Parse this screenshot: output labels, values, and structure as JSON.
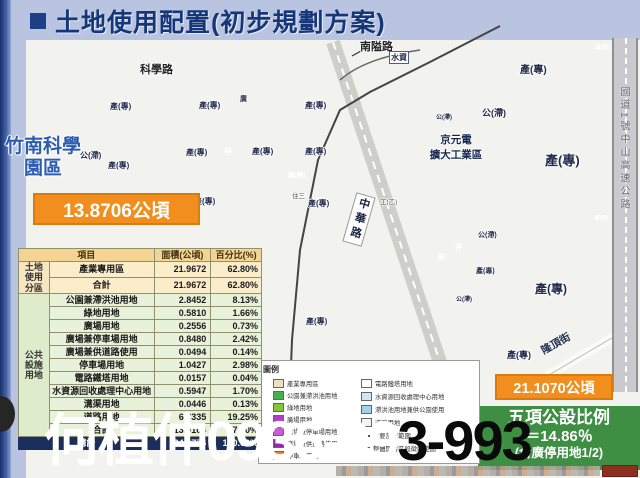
{
  "title": {
    "text": "土地使用配置(初步規劃方案)"
  },
  "watermark": {
    "white": "何植仲0936-99",
    "black": "3-993"
  },
  "colors": {
    "orange_box": "#f28e1d",
    "green_box": "#3e8f43",
    "total_row": "#1c2f5c",
    "title": "#16367a"
  },
  "map": {
    "roads": {
      "kexue": "科學路",
      "nanai": "南隘路",
      "zhonghua": "中華路",
      "longding": "隆頂街",
      "highway": "國道1號中山高速公路",
      "shuizi": "水資"
    },
    "labels": {
      "industrial": "產(專)",
      "park": "公(滯)",
      "parking": "停",
      "green": "綠",
      "plaza": "廣",
      "plaza_parking": "廣(停)",
      "plaza_road": "廣(道)",
      "jingyuan": "京元電\n擴大工業區",
      "zhusan": "住三",
      "gongyi": "工(乙)"
    },
    "science_park_name": "竹南科學園區",
    "left_area": "13.8706公頃",
    "right_area": "21.1070公頃",
    "ratio_box": {
      "line1": "五項公設比例",
      "line2": "＝14.86％",
      "line3": "(含廣停用地1/2)"
    }
  },
  "legend": {
    "title": "圖例",
    "left": [
      {
        "label": "產業專用區",
        "color": "#f0e0c0"
      },
      {
        "label": "公園兼滯洪池用地",
        "color": "#44b14b"
      },
      {
        "label": "綠地用地",
        "color": "#86c43e"
      },
      {
        "label": "廣場用地",
        "color": "#b03fc6"
      },
      {
        "label": "廣場兼停車場用地",
        "color": "#c45fd4"
      },
      {
        "label": "廣場兼供道路使用",
        "color": "#8e2aa8"
      },
      {
        "label": "停車場用地",
        "color": "#ef8432"
      }
    ],
    "right": [
      {
        "label": "電路鐵塔用地",
        "color": "#ffffff"
      },
      {
        "label": "水資源回收處理中心用地",
        "color": "#cfe7f2"
      },
      {
        "label": "滯洪池用地兼供公園使用",
        "color": "#9fd4e8"
      },
      {
        "label": "道路用地",
        "color": "#f5f5f0"
      },
      {
        "label": "主要計畫範圍",
        "color": "#444444"
      },
      {
        "label": "整體開發區段徵收範圍",
        "color": "#ffffff"
      }
    ]
  },
  "table": {
    "headers": {
      "item": "項目",
      "area": "面積(公頃)",
      "pct": "百分比(%)"
    },
    "group1": "土地使用分區",
    "group2": "公共設施用地",
    "rows": [
      [
        "產業專用區",
        "21.9672",
        "62.80%"
      ],
      [
        "合計",
        "21.9672",
        "62.80%"
      ],
      [
        "公園兼滯洪池用地",
        "2.8452",
        "8.13%"
      ],
      [
        "綠地用地",
        "0.5810",
        "1.66%"
      ],
      [
        "廣場用地",
        "0.2556",
        "0.73%"
      ],
      [
        "廣場兼停車場用地",
        "0.8480",
        "2.42%"
      ],
      [
        "廣場兼供道路使用",
        "0.0494",
        "0.14%"
      ],
      [
        "停車場用地",
        "1.0427",
        "2.98%"
      ],
      [
        "電路鐵塔用地",
        "0.0157",
        "0.04%"
      ],
      [
        "水資源回收處理中心用地",
        "0.5947",
        "1.70%"
      ],
      [
        "溝渠用地",
        "0.0446",
        "0.13%"
      ],
      [
        "道路用地",
        "6.7335",
        "19.25%"
      ],
      [
        "合計",
        "13.0104",
        "37.20%"
      ]
    ],
    "total": [
      "總計",
      "34.9776",
      "100.00%"
    ]
  }
}
